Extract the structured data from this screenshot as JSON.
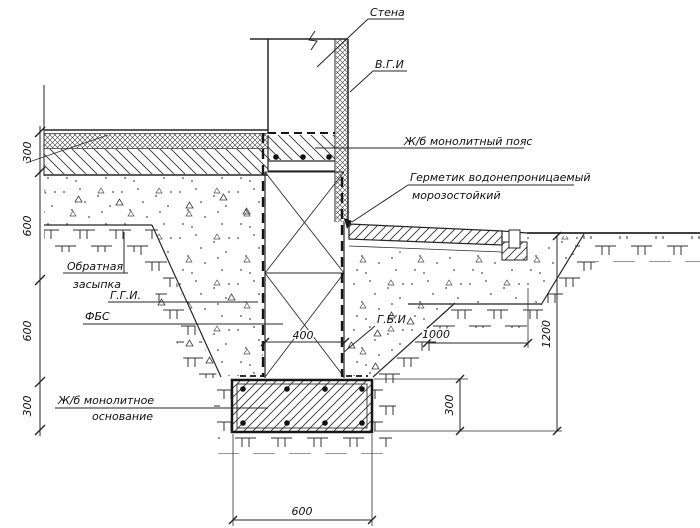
{
  "drawing": {
    "callouts": {
      "wall": "Стена",
      "vgi": "В.Г.И",
      "belt": "Ж/б монолитный пояс",
      "sealant_line1": "Герметик водонепроницаемый",
      "sealant_line2": "морозостойкий",
      "backfill_line1": "Обратная",
      "backfill_line2": "засыпка",
      "ggi": "Г.Г.И.",
      "fbs": "ФБС",
      "gbi": "Г.Б.И",
      "base_line1": "Ж/б монолитное",
      "base_line2": "основание"
    },
    "dimensions": {
      "left_chain": [
        "300",
        "600",
        "600",
        "300"
      ],
      "wall_width": "400",
      "slope_width": "1000",
      "pit_depth": "1200",
      "footing_height": "300",
      "footing_width": "600"
    },
    "colors": {
      "line": "#262626",
      "text": "#101010",
      "background": "#ffffff"
    }
  }
}
